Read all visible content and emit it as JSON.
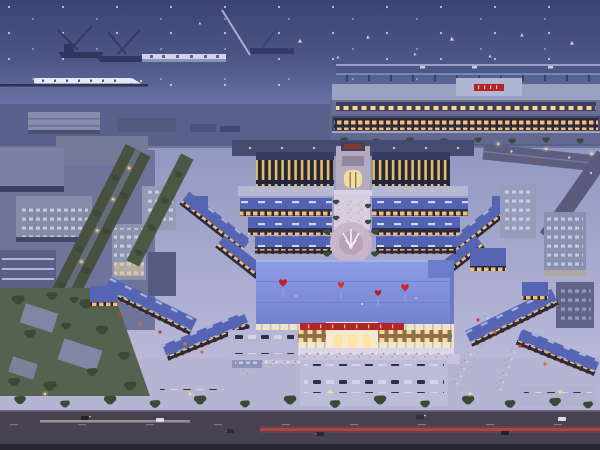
{
  "alt": "Aerial dusk rendering of a large illuminated waterfront commercial complex: a symmetric shopping plaza with blue roofs and gold-lit arcades, a central circular plaza with a white sculpture, a grand front hall with a red signboard and red heart-shaped balloons floating above, a harbor with ships, sailboats and a long pier at the top, an illuminated terminal building, tree-lined streets, parking lots full of cars and a wide road with light trails at the bottom.",
  "counts": {
    "heart_balloons": 4
  },
  "colors": {
    "water_top": "#3c4472",
    "water_mid": "#4d5686",
    "water_near": "#6d78ac",
    "quay": "#5a608c",
    "ground_top": "#9298c2",
    "ground_bottom": "#c2c1de",
    "plaza_band": "#b5b4d2",
    "promenade": "#d6cde0",
    "roof_market": "#5163b2",
    "roof_main_light": "#8e9ce8",
    "roof_main_dark": "#7483d0",
    "terminal_body": "#6b7099",
    "terminal_roof": "#9aa2c2",
    "facade": "#efe6d2",
    "accent_red": "#b5242a",
    "heart_red": "#c2212a",
    "arcade_gold": "#f3c169",
    "window_warm": "#ffd98d",
    "window_cool": "#cfe0f0",
    "park_green": "#55624f",
    "tree_green": "#3a4a36",
    "road": "#474252",
    "taillight": "#c0453c",
    "headlight": "#ddd6c2",
    "lamp_glow": "#ffd98a",
    "ship_dark": "#2f3660",
    "train_white": "#e6e9f4"
  }
}
